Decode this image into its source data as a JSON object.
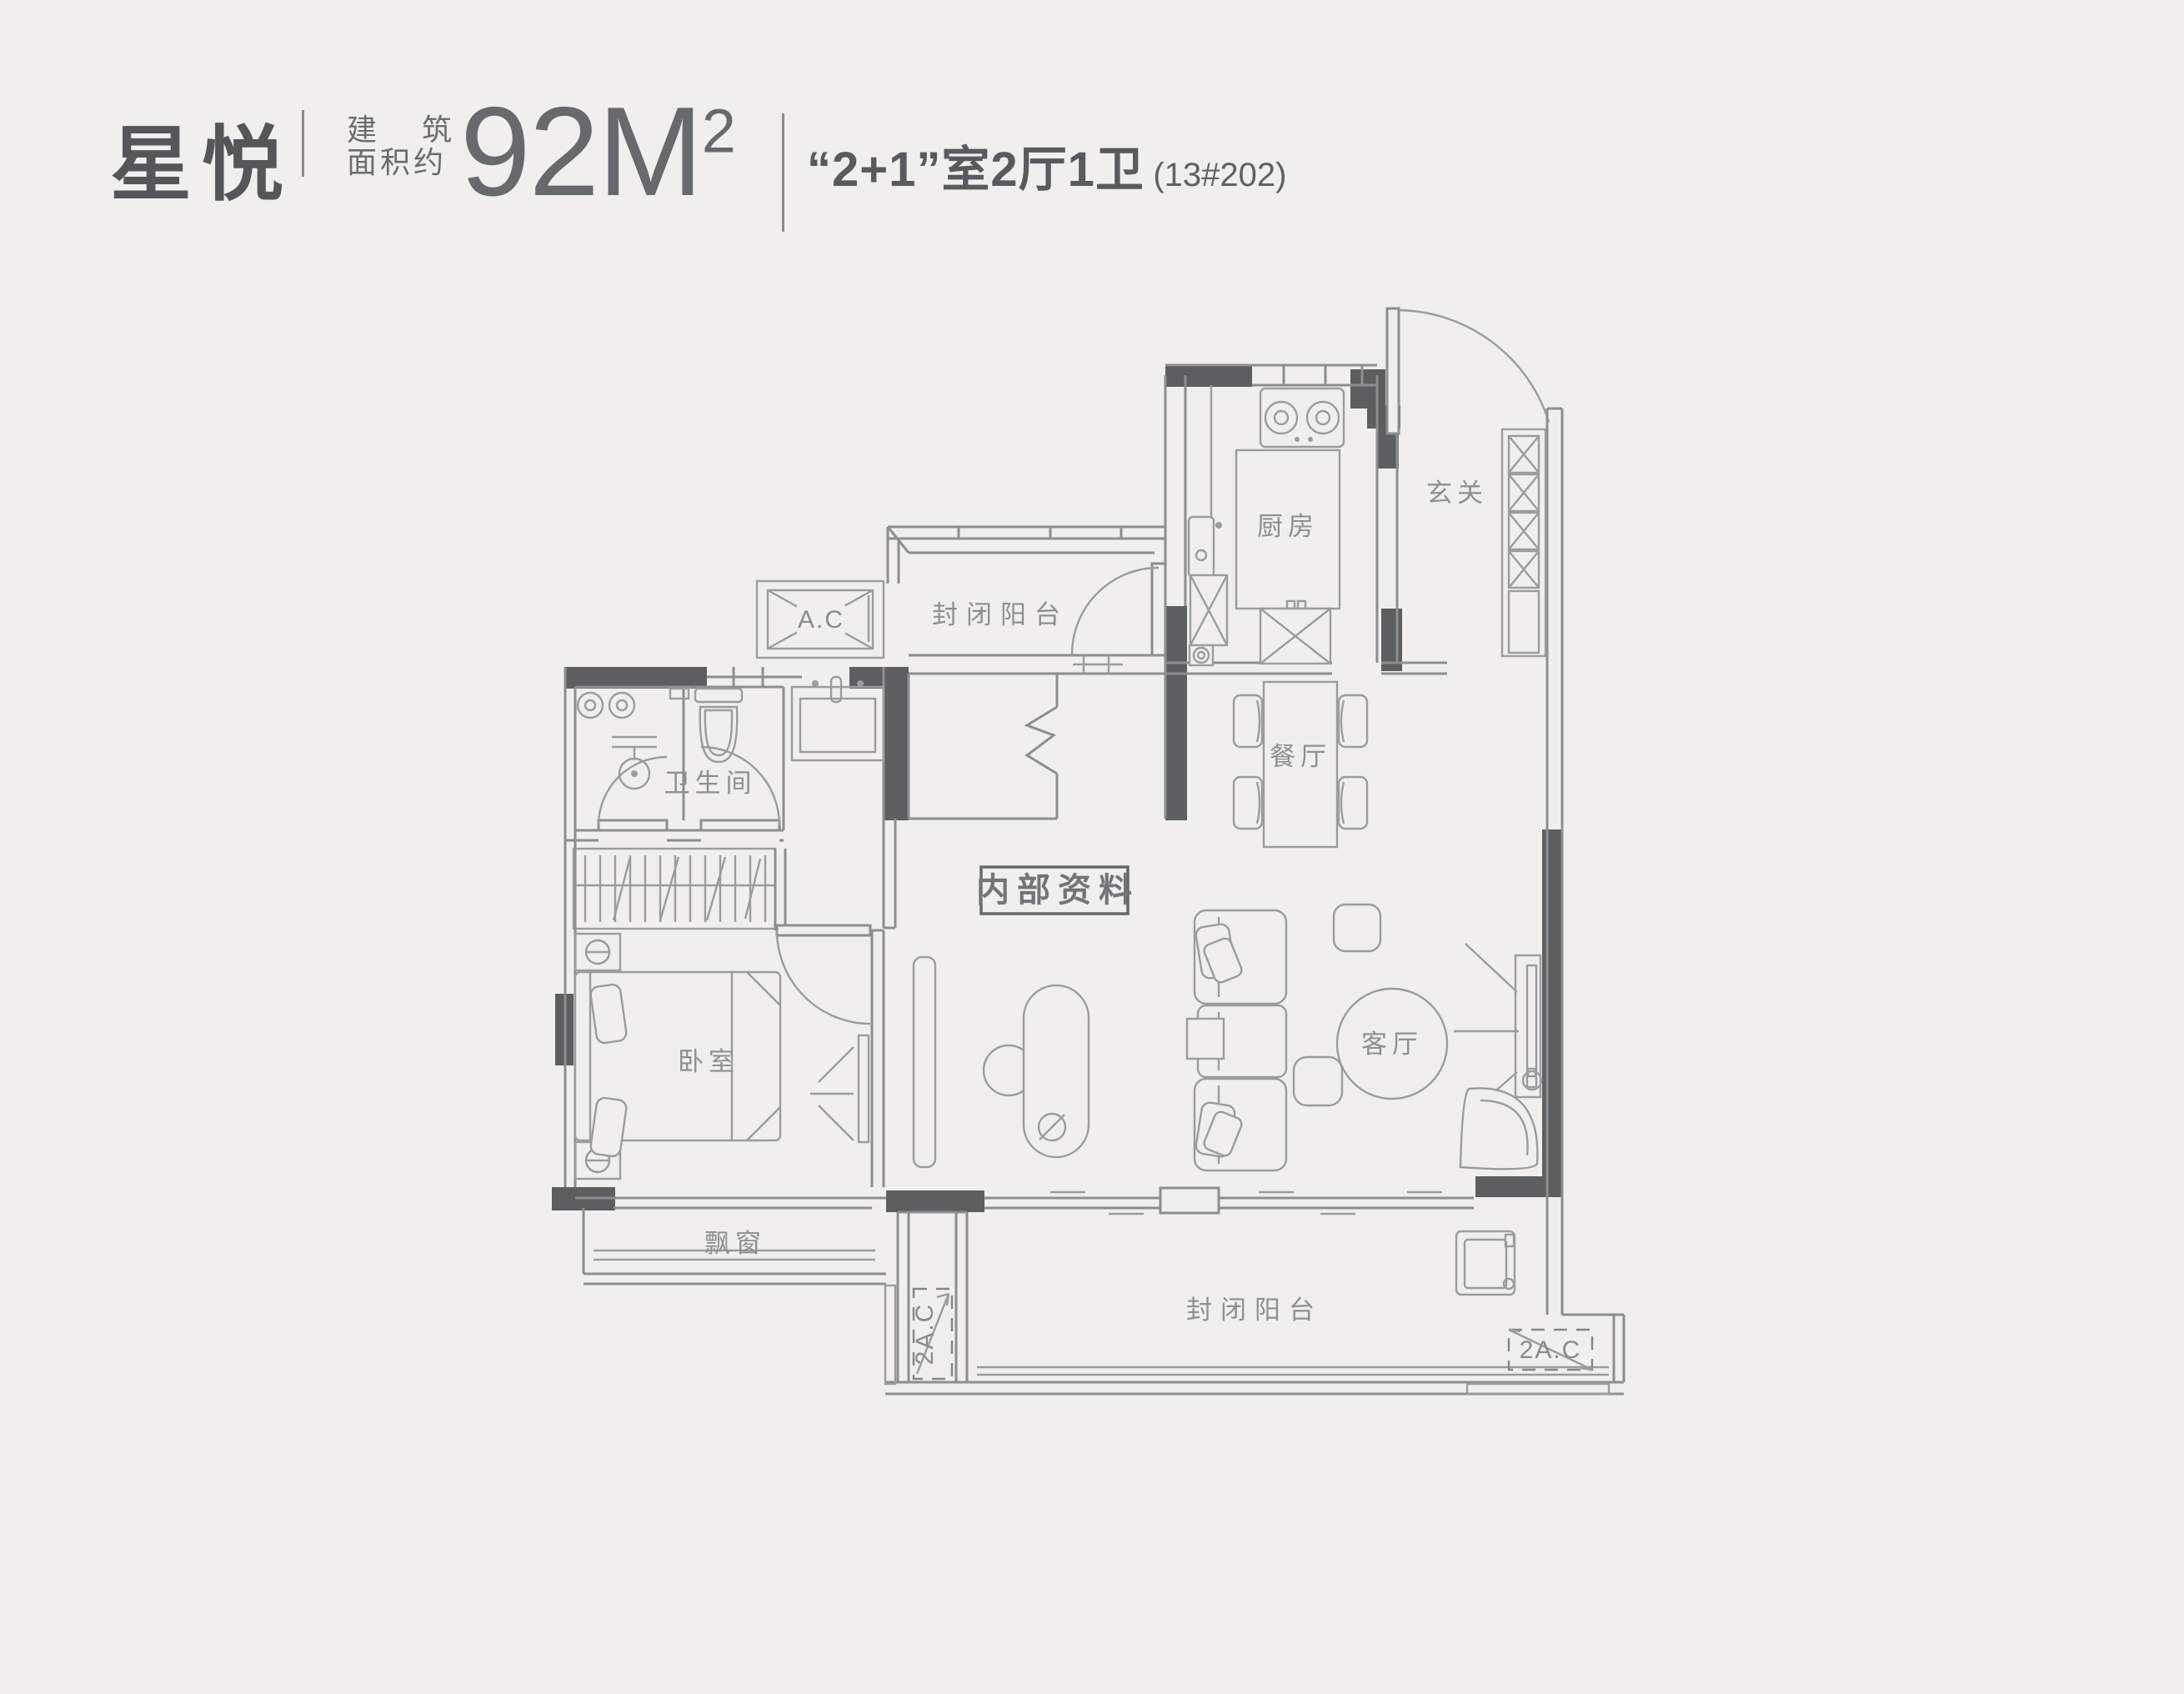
{
  "header": {
    "title": "星悦",
    "area_label_char1": "建",
    "area_label_char2": "筑",
    "area_label_line2": "面积约",
    "area_value": "92M",
    "area_sup": "2",
    "layout_text": "“2+1”室2厅1卫",
    "unit_number": "(13#202)"
  },
  "plan": {
    "rooms": {
      "entry": "玄关",
      "kitchen": "厨房",
      "balcony_top": "封闭阳台",
      "bathroom": "卫生间",
      "dining": "餐厅",
      "bedroom": "卧室",
      "living": "客厅",
      "bay_window": "飘窗",
      "balcony_bottom": "封闭阳台"
    },
    "labels": {
      "watermark": "内部资料",
      "ac": "A.C",
      "ac2_left": "2A.C",
      "ac2_right": "2A.C"
    },
    "colors": {
      "background": "#f0efed",
      "wall_dark": "#5d5e60",
      "wall_line": "#8d8e90",
      "furniture_line": "#9b9c9e",
      "label_text": "#8e8f91",
      "header_text": "#55565a"
    }
  }
}
